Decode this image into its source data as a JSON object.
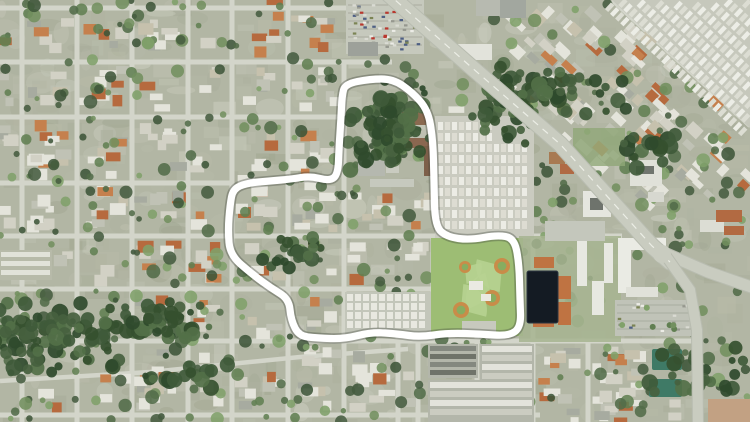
{
  "canvas": {
    "width": 750,
    "height": 422
  },
  "render": {
    "seed": 11,
    "texture_patches": 680,
    "houses": 430,
    "house_attempts": 2600,
    "trees": 540
  },
  "colors": {
    "ground": "#b2b6a4",
    "texture": [
      "#c4c6b7",
      "#aeb29f",
      "#b9bcaa",
      "#a5a996",
      "#ced0c3",
      "#9fa58f"
    ],
    "house": [
      "#e4e4db",
      "#e4e4db",
      "#e4e4db",
      "#d2d1c5",
      "#d2d1c5",
      "#c0c2b5",
      "#a7aba0",
      "#c6c1ad",
      "#c5804d",
      "#b66a3e"
    ],
    "tree": [
      "#72905f",
      "#617f52",
      "#526c49",
      "#465c40",
      "#80a16a",
      "#3e5539"
    ],
    "forest": [
      "#3f5a3a",
      "#35502f",
      "#46613f",
      "#2f4a2c",
      "#527048"
    ],
    "street": "#d3d5ca",
    "cars": [
      "#ecece6",
      "#b8382e",
      "#4e5f83",
      "#96988f",
      "#dadbd3",
      "#7b8454"
    ],
    "highway": {
      "bed": "#b8bcb0",
      "surface": "#c9ccc0",
      "line": "#eceee6"
    }
  },
  "boundary": {
    "stroke": "#ffffff",
    "shadow": "rgba(60,66,56,0.35)",
    "width": 7.2,
    "shadow_width": 10.5,
    "points": [
      [
        345,
        84
      ],
      [
        370,
        79
      ],
      [
        393,
        79
      ],
      [
        412,
        92
      ],
      [
        428,
        110
      ],
      [
        433,
        140
      ],
      [
        434,
        182
      ],
      [
        435,
        226
      ],
      [
        447,
        237
      ],
      [
        470,
        240
      ],
      [
        497,
        235
      ],
      [
        514,
        238
      ],
      [
        519,
        262
      ],
      [
        520,
        300
      ],
      [
        521,
        327
      ],
      [
        509,
        336
      ],
      [
        480,
        334
      ],
      [
        448,
        333
      ],
      [
        420,
        337
      ],
      [
        398,
        334
      ],
      [
        372,
        332
      ],
      [
        344,
        339
      ],
      [
        317,
        338
      ],
      [
        299,
        336
      ],
      [
        291,
        320
      ],
      [
        289,
        299
      ],
      [
        271,
        288
      ],
      [
        252,
        274
      ],
      [
        230,
        255
      ],
      [
        228,
        230
      ],
      [
        230,
        205
      ],
      [
        233,
        189
      ],
      [
        247,
        183
      ],
      [
        270,
        181
      ],
      [
        292,
        179
      ],
      [
        310,
        176
      ],
      [
        330,
        181
      ],
      [
        338,
        174
      ],
      [
        339,
        148
      ],
      [
        341,
        118
      ],
      [
        342,
        96
      ]
    ]
  },
  "streets": {
    "width": 5,
    "vertical": [
      [
        22,
        0,
        422
      ],
      [
        77,
        0,
        422
      ],
      [
        132,
        0,
        422
      ],
      [
        188,
        0,
        422
      ],
      [
        232,
        0,
        422
      ],
      [
        288,
        0,
        422
      ],
      [
        344,
        62,
        422
      ],
      [
        398,
        288,
        422
      ],
      [
        418,
        337,
        422
      ],
      [
        433,
        236,
        341
      ],
      [
        477,
        337,
        422
      ],
      [
        533,
        234,
        422
      ],
      [
        588,
        341,
        422
      ]
    ],
    "horizontal": [
      [
        8,
        0,
        346
      ],
      [
        62,
        0,
        392
      ],
      [
        117,
        0,
        350
      ],
      [
        183,
        0,
        233
      ],
      [
        236,
        0,
        622
      ],
      [
        289,
        0,
        434
      ],
      [
        341,
        0,
        698
      ],
      [
        415,
        0,
        540
      ]
    ],
    "diagonals": [
      [
        [
          0,
          381
        ],
        [
          150,
          372
        ],
        [
          300,
          357
        ],
        [
          408,
          349
        ]
      ],
      [
        [
          612,
          0
        ],
        [
          750,
          126
        ]
      ]
    ]
  },
  "highway": {
    "main": [
      [
        386,
        -8
      ],
      [
        470,
        66
      ],
      [
        560,
        144
      ],
      [
        652,
        246
      ],
      [
        670,
        262
      ]
    ],
    "east": [
      [
        662,
        252
      ],
      [
        708,
        272
      ],
      [
        754,
        288
      ]
    ],
    "south": [
      [
        666,
        256
      ],
      [
        690,
        290
      ],
      [
        697,
        330
      ],
      [
        698,
        426
      ]
    ],
    "axis": {
      "a": [
        386,
        -6
      ],
      "b": [
        668,
        258
      ]
    },
    "widths": {
      "main": 15,
      "east": 11,
      "south": 10
    }
  },
  "zones": {
    "no_house": [
      [
        343,
        0,
        192,
        62
      ],
      [
        338,
        62,
        104,
        126
      ],
      [
        432,
        112,
        104,
        128
      ],
      [
        429,
        234,
        96,
        104
      ],
      [
        517,
        234,
        104,
        108
      ],
      [
        341,
        288,
        94,
        50
      ],
      [
        424,
        341,
        112,
        81
      ],
      [
        541,
        126,
        78,
        118
      ],
      [
        610,
        126,
        140,
        116
      ],
      [
        610,
        215,
        140,
        130
      ],
      [
        686,
        215,
        64,
        210
      ],
      [
        0,
        246,
        58,
        36
      ]
    ],
    "no_tree": [
      [
        434,
        116,
        100,
        120
      ],
      [
        431,
        238,
        92,
        98
      ],
      [
        523,
        266,
        40,
        62
      ],
      [
        345,
        0,
        138,
        56
      ],
      [
        615,
        0,
        135,
        70
      ]
    ],
    "forest_core": {
      "cx": 42,
      "cy": 338,
      "rx": 95,
      "ry": 46
    }
  },
  "features": {
    "parking_top": {
      "rect": [
        346,
        0,
        78,
        54
      ],
      "fill": "#c6c9bd",
      "row_gap": 8,
      "cars": 60
    },
    "top_buildings": [
      [
        348,
        42,
        30,
        14,
        "#9da19a"
      ],
      [
        458,
        44,
        34,
        16,
        "#e2e3db"
      ],
      [
        476,
        0,
        32,
        16,
        "#b7bab0"
      ],
      [
        500,
        0,
        26,
        18,
        "#a2a79f"
      ]
    ],
    "campus": [
      [
        402,
        112,
        24,
        13,
        "#8a6a50"
      ],
      [
        403,
        138,
        32,
        10,
        "#8a6750"
      ],
      [
        424,
        146,
        10,
        30,
        "#7d5f49"
      ],
      [
        358,
        152,
        27,
        24,
        "#b5b8af"
      ],
      [
        386,
        162,
        13,
        11,
        "#c9cbc0"
      ],
      [
        370,
        179,
        44,
        8,
        "#c6c9be"
      ]
    ],
    "trailer_west": {
      "rect": [
        435,
        116,
        99,
        122
      ],
      "base": "#cacbc0",
      "row_step": 11,
      "unit_w": 5,
      "unit_h": 8,
      "unit_step": 7,
      "fills": [
        "#ecece5",
        "#dddcd2"
      ],
      "narrow_until_y": 140,
      "narrow_max_x": 498
    },
    "rows_strip": {
      "rect": [
        345,
        292,
        86,
        42
      ],
      "base": "#c3c6ba",
      "row_step": 9,
      "unit_w": 6,
      "unit_h": 7,
      "unit_step": 8,
      "fill": "#e8e8e0"
    },
    "apartment_rows_left": {
      "rect": [
        0,
        250,
        52,
        30
      ],
      "base": "#b7baa9",
      "row_step": 9,
      "h": 5,
      "fill": "#e1e2d9"
    },
    "ballpark": {
      "rect": [
        431,
        238,
        92,
        98
      ],
      "grass": "#9dbd74",
      "fan": "#b7d291",
      "dirt": "#c98c49",
      "infield": "#87ad60",
      "fields": [
        [
          502,
          266,
          145,
          26,
          8
        ],
        [
          492,
          298,
          205,
          26,
          8
        ],
        [
          461,
          310,
          325,
          26,
          8
        ],
        [
          465,
          267,
          35,
          17,
          6
        ]
      ],
      "buildings": [
        [
          469,
          281,
          14,
          9
        ],
        [
          481,
          294,
          10,
          7
        ]
      ],
      "building_fill": "#eaeae2",
      "parking": [
        462,
        321,
        34,
        13
      ],
      "parking_fill": "#c7c9be"
    },
    "pond_campus": {
      "base": [
        519,
        236,
        102,
        106
      ],
      "base_fill": "#a6b491",
      "pond": [
        527,
        271,
        31,
        52
      ],
      "pond_fill": "#141b23",
      "pond_stroke": "#2b3541",
      "orange": [
        [
          558,
          276,
          13,
          23
        ],
        [
          558,
          302,
          13,
          23
        ],
        [
          534,
          257,
          20,
          11
        ],
        [
          533,
          311,
          21,
          16
        ]
      ],
      "orange_fill": "#bf7342",
      "slabs": [
        [
          577,
          240,
          10,
          46
        ],
        [
          592,
          281,
          12,
          34
        ],
        [
          604,
          243,
          9,
          40
        ]
      ],
      "slab_fill": "#e7e8e1"
    },
    "commercial_strip": [
      [
        583,
        191,
        28,
        26,
        "#e5e6df"
      ],
      [
        590,
        198,
        13,
        12,
        "#6e736c"
      ],
      [
        549,
        152,
        16,
        12,
        "#a87a52"
      ],
      [
        560,
        164,
        14,
        10,
        "#b06a44"
      ],
      [
        545,
        221,
        60,
        20,
        "#c4c7bc"
      ]
    ],
    "ne_block": {
      "lawn": [
        573,
        128,
        52,
        38,
        "#90a878"
      ],
      "slabs": [
        [
          630,
          160,
          32,
          26,
          "#e0e1d9"
        ],
        [
          636,
          166,
          18,
          8,
          "#70756e"
        ],
        [
          648,
          192,
          16,
          10,
          "#d7d8d0"
        ]
      ]
    },
    "apartment_right": {
      "l_building": [
        [
          618,
          238,
          48,
          12
        ],
        [
          618,
          238,
          13,
          55
        ]
      ],
      "white": "#eaebe4",
      "slabs": [
        [
          626,
          287,
          32,
          10,
          "#e0e1d9"
        ],
        [
          700,
          220,
          24,
          12,
          "#dcddd4"
        ]
      ],
      "parking": [
        615,
        300,
        78,
        36
      ],
      "parking_fill": "#c0c3b8",
      "orange": [
        [
          716,
          210,
          26,
          12
        ],
        [
          724,
          226,
          20,
          9
        ]
      ],
      "orange_fill": "#b26a42"
    },
    "civic": {
      "teal": [
        [
          652,
          349,
          30,
          21
        ],
        [
          649,
          379,
          33,
          18
        ]
      ],
      "teal_fill": "#3f7a66",
      "tan": [
        708,
        399,
        42,
        23
      ],
      "tan_fill": "#c2a183"
    },
    "townhouses": {
      "dark": {
        "rect": [
          428,
          344,
          50,
          34
        ],
        "step": 8,
        "h": 5,
        "fills": [
          "#84887f",
          "#6f7369"
        ]
      },
      "light": {
        "rect": [
          428,
          380,
          106,
          42
        ],
        "step": 9,
        "h": 6,
        "fills": [
          "#e3e3db",
          "#cbccc1"
        ]
      },
      "light2": {
        "rect": [
          480,
          344,
          54,
          36
        ],
        "step": 9,
        "h": 6,
        "fills": [
          "#e3e3db",
          "#cbccc1"
        ]
      }
    },
    "trailer_ne": {
      "clip": [
        [
          612,
          0
        ],
        [
          750,
          0
        ],
        [
          750,
          128
        ]
      ],
      "base": "#c6c8bc",
      "origin": [
        685,
        55
      ],
      "angle": 43,
      "row_step": 12,
      "unit_step": 7,
      "unit_w": 4.5,
      "unit_h": 9,
      "fills": [
        "#ecede6",
        "#dcddd3"
      ]
    },
    "forest": [
      {
        "cx": 42,
        "cy": 338,
        "rx": 88,
        "ry": 40,
        "n": 110
      },
      {
        "cx": 152,
        "cy": 322,
        "rx": 62,
        "ry": 26,
        "n": 55
      },
      {
        "cx": 390,
        "cy": 128,
        "rx": 48,
        "ry": 50,
        "n": 85
      },
      {
        "cx": 505,
        "cy": 108,
        "rx": 42,
        "ry": 44,
        "n": 45
      },
      {
        "cx": 560,
        "cy": 92,
        "rx": 75,
        "ry": 26,
        "n": 40
      },
      {
        "cx": 640,
        "cy": 150,
        "rx": 40,
        "ry": 22,
        "n": 18
      },
      {
        "cx": 700,
        "cy": 370,
        "rx": 55,
        "ry": 30,
        "n": 25
      },
      {
        "cx": 300,
        "cy": 250,
        "rx": 40,
        "ry": 22,
        "n": 22
      },
      {
        "cx": 180,
        "cy": 370,
        "rx": 60,
        "ry": 20,
        "n": 20
      }
    ]
  }
}
